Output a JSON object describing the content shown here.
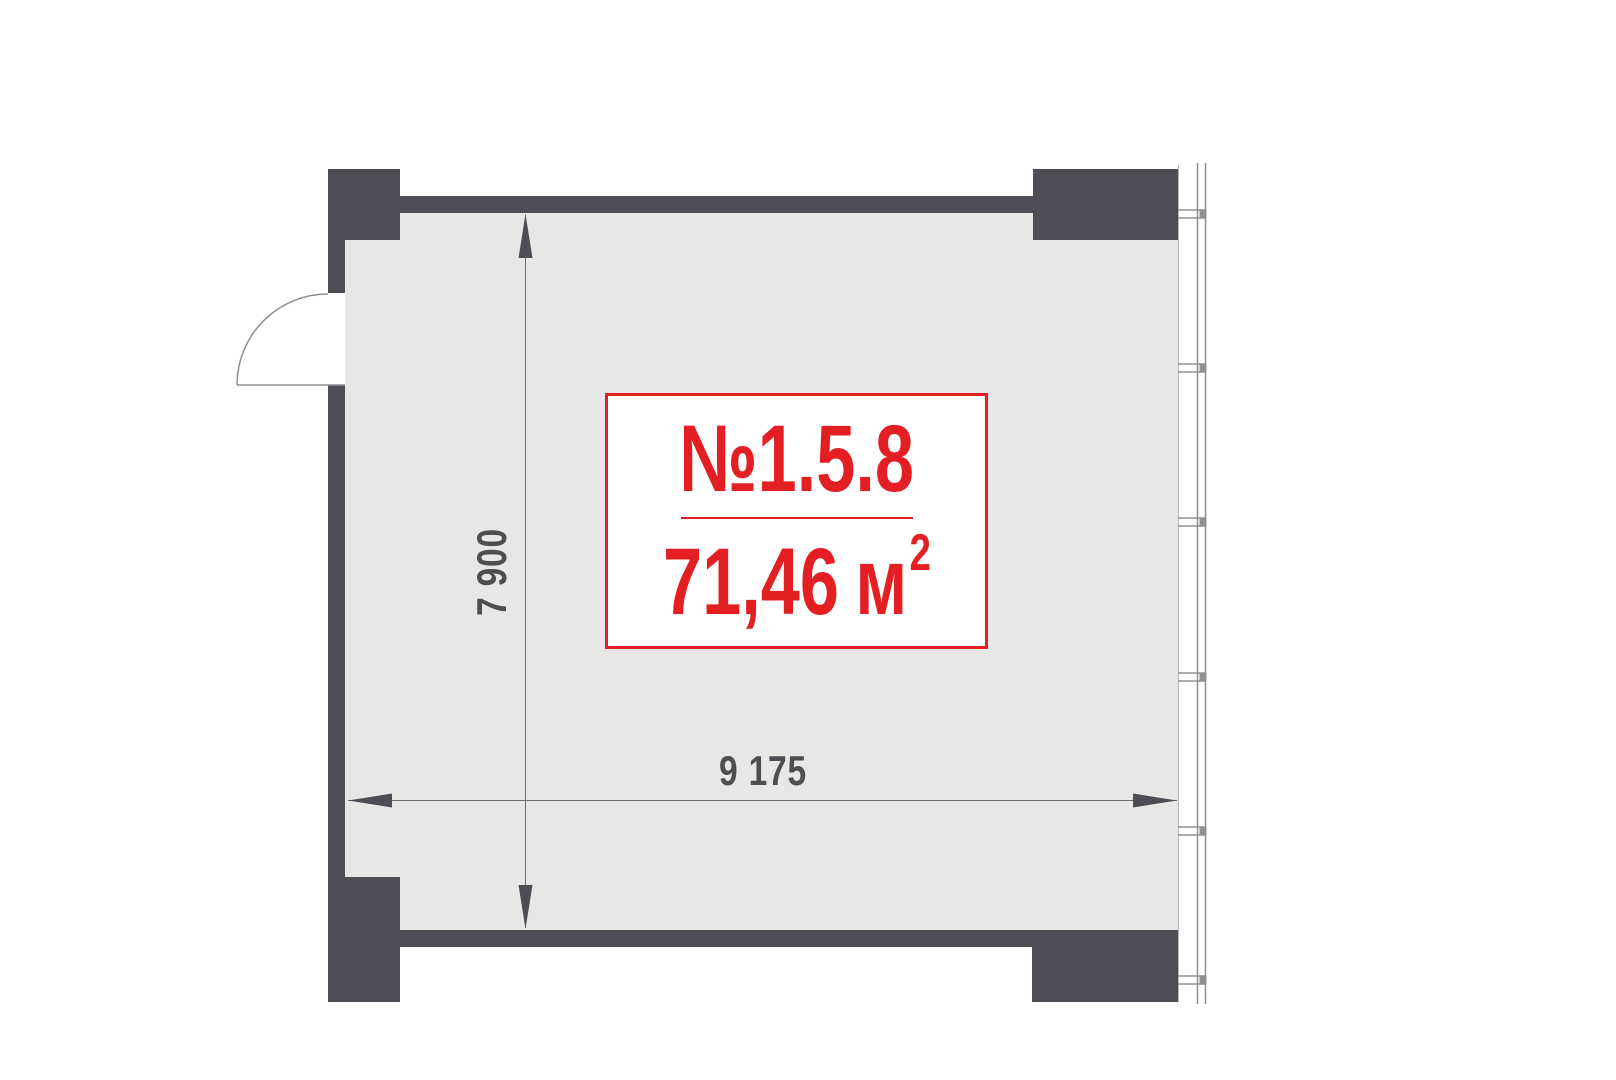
{
  "floorplan": {
    "unit": {
      "number": "№1.5.8",
      "area_value": "71,46",
      "area_unit": "м",
      "area_superscript": "2"
    },
    "dimensions": {
      "width_mm": "9 175",
      "height_mm": "7 900"
    },
    "colors": {
      "wall": "#4d4d55",
      "floor": "#e8e7e5",
      "accent_red": "#e41f24",
      "dimension_text": "#4d4d52",
      "window_line": "#909094"
    }
  }
}
